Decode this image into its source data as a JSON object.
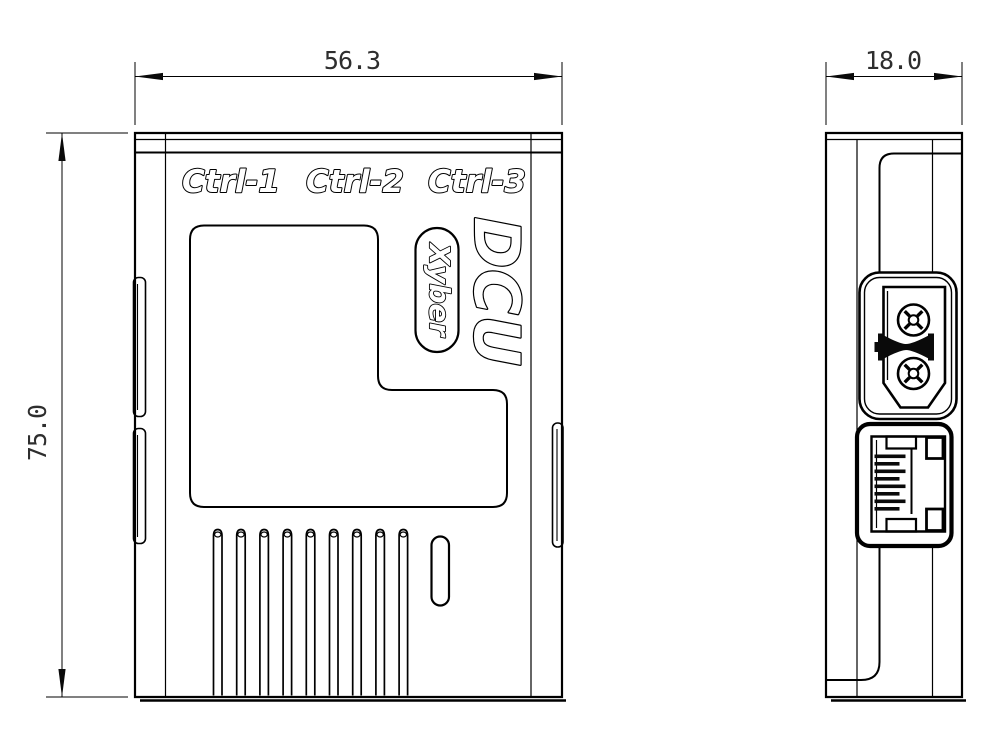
{
  "front_view": {
    "width_dim": "56.3",
    "height_dim": "75.0",
    "port_labels": [
      "Ctrl-1",
      "Ctrl-2",
      "Ctrl-3"
    ],
    "product_logo": "DCU",
    "brand_logo": "Xyber",
    "vent_slot_count": 9
  },
  "side_view": {
    "depth_dim": "18.0",
    "connectors": [
      "XT30 power connector",
      "RJ45 ethernet port"
    ]
  },
  "colors": {
    "line": "#000000",
    "dim_text": "#2e2e2e",
    "background": "#ffffff"
  }
}
